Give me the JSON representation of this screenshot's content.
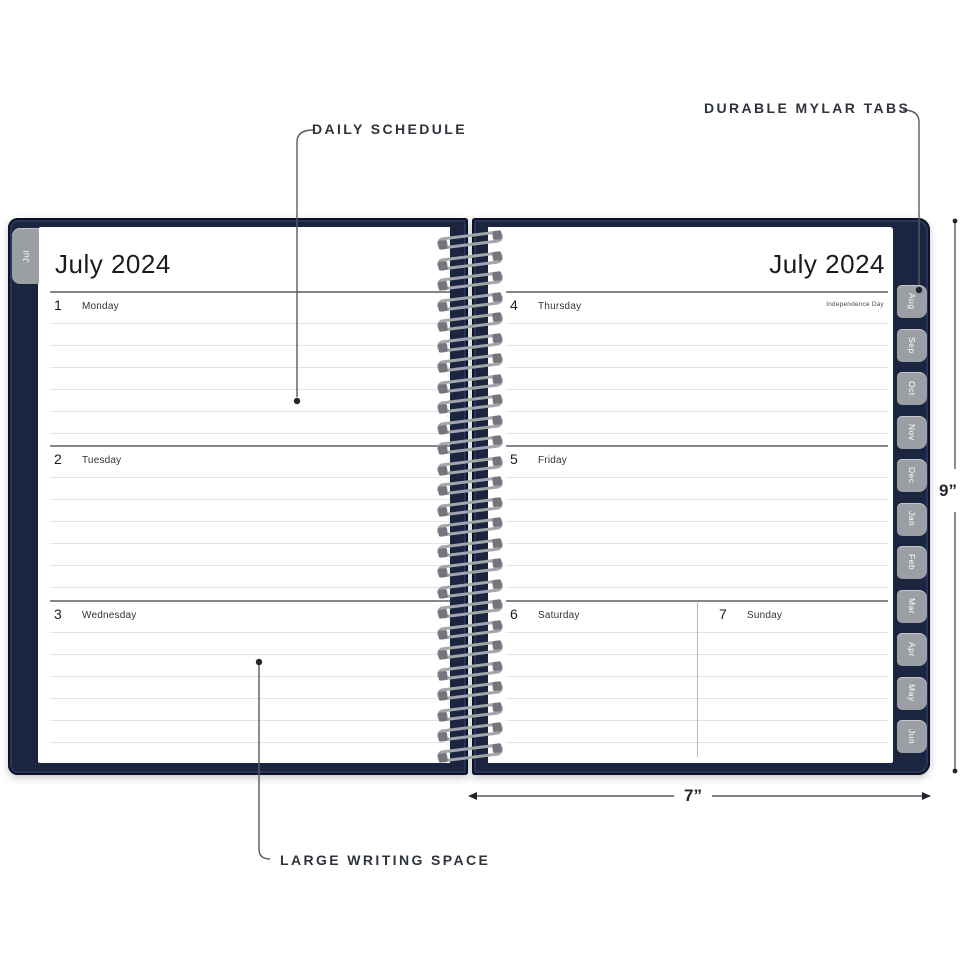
{
  "annotations": {
    "daily_schedule": "DAILY SCHEDULE",
    "durable_mylar_tabs": "DURABLE MYLAR TABS",
    "large_writing_space": "LARGE WRITING SPACE"
  },
  "dimensions": {
    "height_label": "9”",
    "width_label": "7”"
  },
  "left_page": {
    "title": "July 2024",
    "edge_tab_label": "Jul",
    "days": [
      {
        "num": "1",
        "name": "Monday"
      },
      {
        "num": "2",
        "name": "Tuesday"
      },
      {
        "num": "3",
        "name": "Wednesday"
      }
    ]
  },
  "right_page": {
    "title": "July 2024",
    "days": [
      {
        "num": "4",
        "name": "Thursday",
        "note": "Independence Day"
      },
      {
        "num": "5",
        "name": "Friday"
      },
      {
        "num": "6",
        "name": "Saturday"
      },
      {
        "num": "7",
        "name": "Sunday"
      }
    ]
  },
  "month_tabs": [
    "Aug",
    "Sep",
    "Oct",
    "Nov",
    "Dec",
    "Jan",
    "Feb",
    "Mar",
    "Apr",
    "May",
    "Jun"
  ],
  "colors": {
    "cover_navy": "#1b2540",
    "tab_gray": "#9b9fa4",
    "annotation_text": "#2f343b"
  }
}
